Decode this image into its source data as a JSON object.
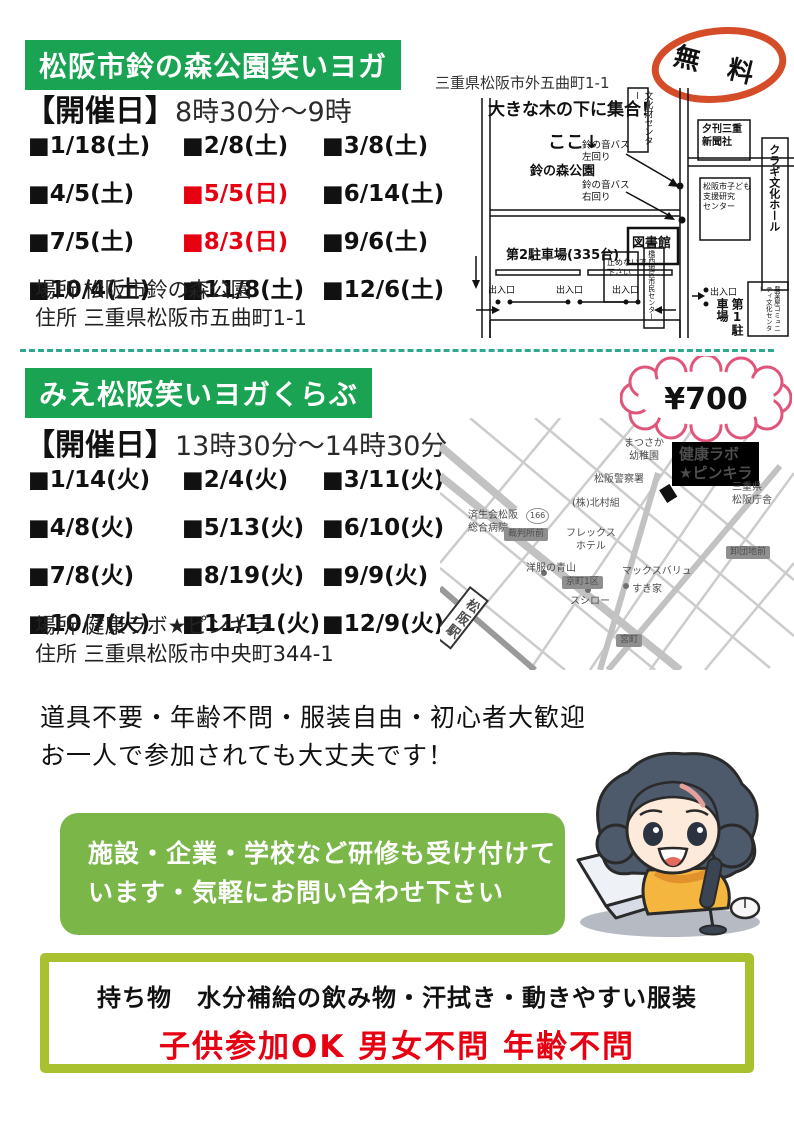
{
  "colors": {
    "header_green": "#1aa352",
    "box_green": "#7ab648",
    "border_lime": "#a9c02f",
    "date_red": "#e60012",
    "free_badge_red": "#d54c28",
    "price_badge_pink": "#e0557a",
    "divider_teal": "#2fa893"
  },
  "section1": {
    "title": "松阪市鈴の森公園笑いヨガ",
    "schedule_label": "【開催日】",
    "schedule_time": "8時30分～9時",
    "dates": [
      {
        "text": "■1/18(土)",
        "red": "false"
      },
      {
        "text": "■2/8(土)",
        "red": "false"
      },
      {
        "text": "■3/8(土)",
        "red": "false"
      },
      {
        "text": "■4/5(土)",
        "red": "false"
      },
      {
        "text": "■5/5(日)",
        "red": "true"
      },
      {
        "text": "■6/14(土)",
        "red": "false"
      },
      {
        "text": "■7/5(土)",
        "red": "false"
      },
      {
        "text": "■8/3(日)",
        "red": "true"
      },
      {
        "text": "■9/6(土)",
        "red": "false"
      },
      {
        "text": "■10/4(土)",
        "red": "false"
      },
      {
        "text": "■11/8(土)",
        "red": "false"
      },
      {
        "text": "■12/6(土)",
        "red": "false"
      }
    ],
    "place": "場所 松阪市鈴の森公園",
    "address": "住所 三重県松阪市五曲町1-1",
    "free_badge": "無 料",
    "map": {
      "address": "三重県松阪市外五曲町1-1",
      "meet": "大きな木の下に集合！",
      "here": "ここ↓",
      "park": "鈴の森公園",
      "bunkazai_center": "文化財センター",
      "newspaper": "夕刊三重\n新聞社",
      "bus_left": "鈴の音バス\n左回り",
      "bus_right": "鈴の音バス\n右回り",
      "kodomo_center": "松阪市子ども\n支援研究\nセンター",
      "kuragi_hall": "クラギ文化ホール",
      "library": "図書館",
      "parking2": "第2駐車場(335台)",
      "no_parking": "止めないで\n下さい",
      "kyosei_center": "橋西地区市民センター",
      "exit": "出入口",
      "parking1": "第1駐車場",
      "community_center": "農業屋コミュニティ文化センター"
    }
  },
  "section2": {
    "title": "みえ松阪笑いヨガくらぶ",
    "schedule_label": "【開催日】",
    "schedule_time": "13時30分～14時30分",
    "price_badge": "¥700",
    "dates": [
      {
        "text": "■1/14(火)",
        "red": "false"
      },
      {
        "text": "■2/4(火)",
        "red": "false"
      },
      {
        "text": "■3/11(火)",
        "red": "false"
      },
      {
        "text": "■4/8(火)",
        "red": "false"
      },
      {
        "text": "■5/13(火)",
        "red": "false"
      },
      {
        "text": "■6/10(火)",
        "red": "false"
      },
      {
        "text": "■7/8(火)",
        "red": "false"
      },
      {
        "text": "■8/19(火)",
        "red": "false"
      },
      {
        "text": "■9/9(火)",
        "red": "false"
      },
      {
        "text": "■10/7(火)",
        "red": "false"
      },
      {
        "text": "■11/11(火)",
        "red": "false"
      },
      {
        "text": "■12/9(火)",
        "red": "false"
      }
    ],
    "place": "場所 健康ラボ★ピンキラ",
    "address": "住所 三重県松阪市中央町344-1",
    "map": {
      "kindergarten": "まつさか\n幼稚園",
      "venue": "健康ラボ\n★ピンキラ",
      "police": "松阪警察署",
      "kitamura": "(株)北村組",
      "pref_office": "三重県\n松阪庁舎",
      "hospital": "済生会松阪\n総合病院",
      "route": "166",
      "bus_courthouse": "裁判所前",
      "hotel": "フレックス\nホテル",
      "bus_oroshi": "卸団地前",
      "aoyama": "洋服の青山",
      "bus_kyomachi": "京町1区",
      "maxvalu": "マックスバリュ",
      "sukiya": "すき家",
      "sushiro": "スシロー",
      "bus_miyamachi": "宮町",
      "station": "松阪駅"
    }
  },
  "notes": {
    "line1": "道具不要・年齢不問・服装自由・初心者大歓迎",
    "line2": "お一人で参加されても大丈夫です！"
  },
  "training_box": {
    "line1": "施設・企業・学校など研修も受け付けて",
    "line2": "います・気軽にお問い合わせ下さい"
  },
  "bottom_box": {
    "belongings": "持ち物　水分補給の飲み物・汗拭き・動きやすい服装",
    "welcome": "子供参加OK 男女不問 年齢不問"
  }
}
